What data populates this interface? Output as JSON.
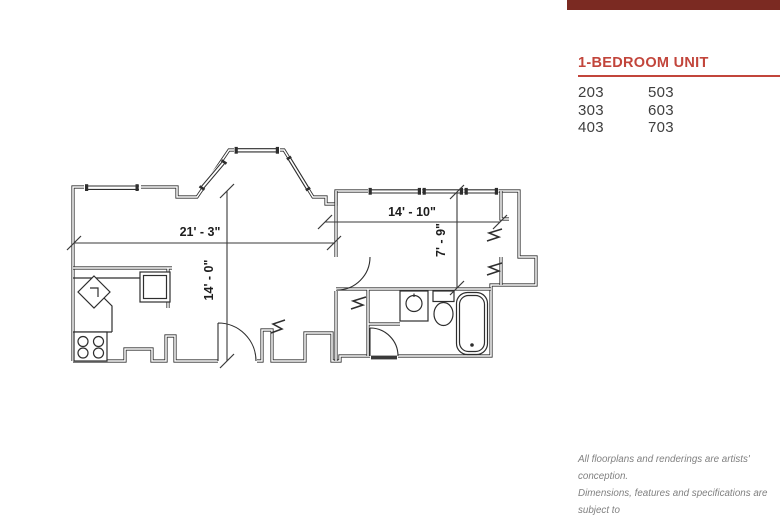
{
  "page": {
    "width": 780,
    "height": 517,
    "background": "#ffffff"
  },
  "accent_bar": {
    "color": "#7b2a22"
  },
  "legend": {
    "title": "1-BEDROOM UNIT",
    "accent_color": "#c2453b",
    "text_color": "#3e3e3e",
    "units_col1": [
      "203",
      "303",
      "403"
    ],
    "units_col2": [
      "503",
      "603",
      "703"
    ]
  },
  "floorplan": {
    "line_color": "#2e2e2e",
    "dimensions": {
      "living_width": "21' - 3\"",
      "bedroom_width": "14' - 10\"",
      "living_depth": "14' - 0\"",
      "bedroom_depth": "7' - 9\""
    },
    "fixtures": [
      "kitchen-sink",
      "refrigerator",
      "range",
      "bathroom-sink",
      "toilet",
      "bathtub"
    ]
  },
  "disclaimer": {
    "color": "#808080",
    "lines": [
      "All floorplans and renderings are artists' conception.",
      "Dimensions, features and specifications are subject to",
      "change at the discretion of the builder."
    ]
  }
}
